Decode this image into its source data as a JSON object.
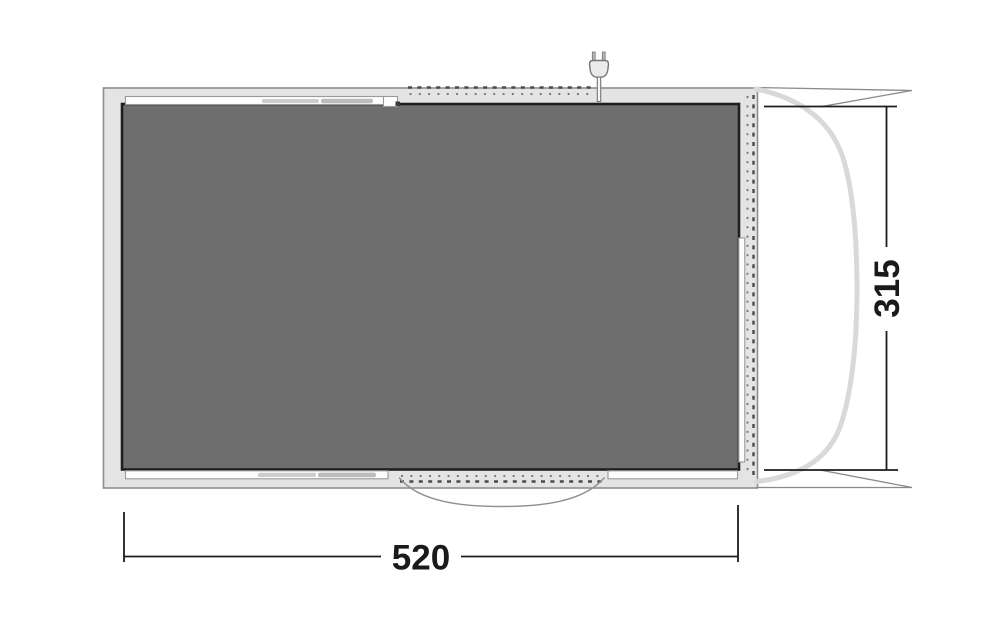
{
  "diagram": {
    "title": "tent-floorplan-top-view",
    "dimensions": {
      "width_label": "520",
      "height_label": "315"
    },
    "colors": {
      "background": "#ffffff",
      "band": "#e4e4e4",
      "band_border": "#8f8f8f",
      "floor": "#6e6e6e",
      "floor_border": "#1f1f1f",
      "strip_fill": "#fdfdfd",
      "strip_border": "#9a9a9a",
      "window_bar_light": "#cdcdcd",
      "window_bar_dark": "#bdbdbd",
      "dash": "#4a4a4a",
      "dot": "#7a7a7a",
      "awning_curve": "#d9d9d9",
      "guy_line": "#8a8a8a",
      "door_arc": "#909090",
      "dimension": "#1c1c1c",
      "plug_fill": "#ebebeb",
      "plug_prong": "#b5b5b5",
      "plug_border": "#767676",
      "notch_dark": "#3a3a3a"
    },
    "icons": {
      "plug": "power-plug-icon"
    }
  }
}
